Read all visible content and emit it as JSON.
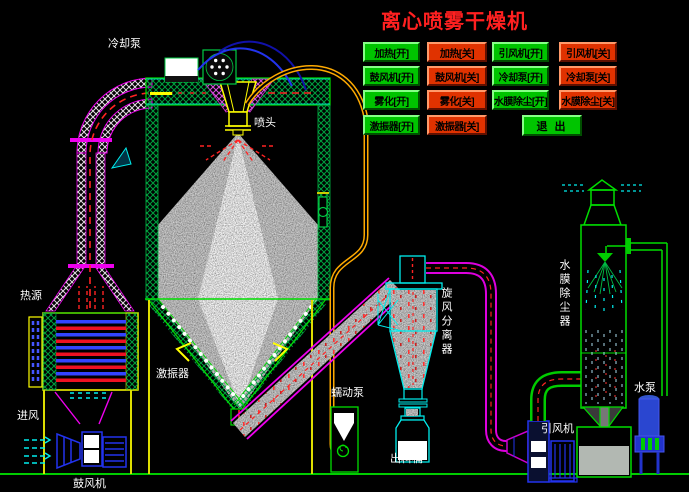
{
  "title": "离心喷雾干燥机",
  "control_panel": {
    "buttons": [
      {
        "label": "加热[开]",
        "state": "on"
      },
      {
        "label": "加热[关]",
        "state": "off"
      },
      {
        "label": "引风机[开]",
        "state": "on"
      },
      {
        "label": "引风机[关]",
        "state": "off"
      },
      {
        "label": "鼓风机[开]",
        "state": "on"
      },
      {
        "label": "鼓风机[关]",
        "state": "off"
      },
      {
        "label": "冷却泵[开]",
        "state": "on"
      },
      {
        "label": "冷却泵[关]",
        "state": "off"
      },
      {
        "label": "雾化[开]",
        "state": "on"
      },
      {
        "label": "雾化[关]",
        "state": "off"
      },
      {
        "label": "水膜除尘[开]",
        "state": "on"
      },
      {
        "label": "水膜除尘[关]",
        "state": "off"
      },
      {
        "label": "激振器[开]",
        "state": "on"
      },
      {
        "label": "激振器[关]",
        "state": "off"
      }
    ],
    "exit_label": "退 出"
  },
  "equipment_labels": {
    "cooling_pump": "冷却泵",
    "spray_head": "喷头",
    "heat_source": "热源",
    "air_inlet": "进风",
    "blower": "鼓风机",
    "vibrator": "激振器",
    "peristaltic_pump": "蠕动泵",
    "discharge_barrel": "出料桶",
    "cyclone_separator": "旋风分离器",
    "induced_draft_fan": "引风机",
    "water_film_dust_collector": "水膜除尘器",
    "water_pump": "水泵"
  },
  "colors": {
    "background": "#000000",
    "title": "#ff2020",
    "button_on": "#00c400",
    "button_off": "#e03200",
    "label_white": "#ffffff",
    "line_green": "#00dd00",
    "line_magenta": "#ee00ee",
    "line_cyan": "#00eeee",
    "line_yellow": "#ffff00",
    "pipe_orange": "#ffaa00",
    "machine_blue": "#2233ee",
    "dash_red": "#ff2222"
  }
}
